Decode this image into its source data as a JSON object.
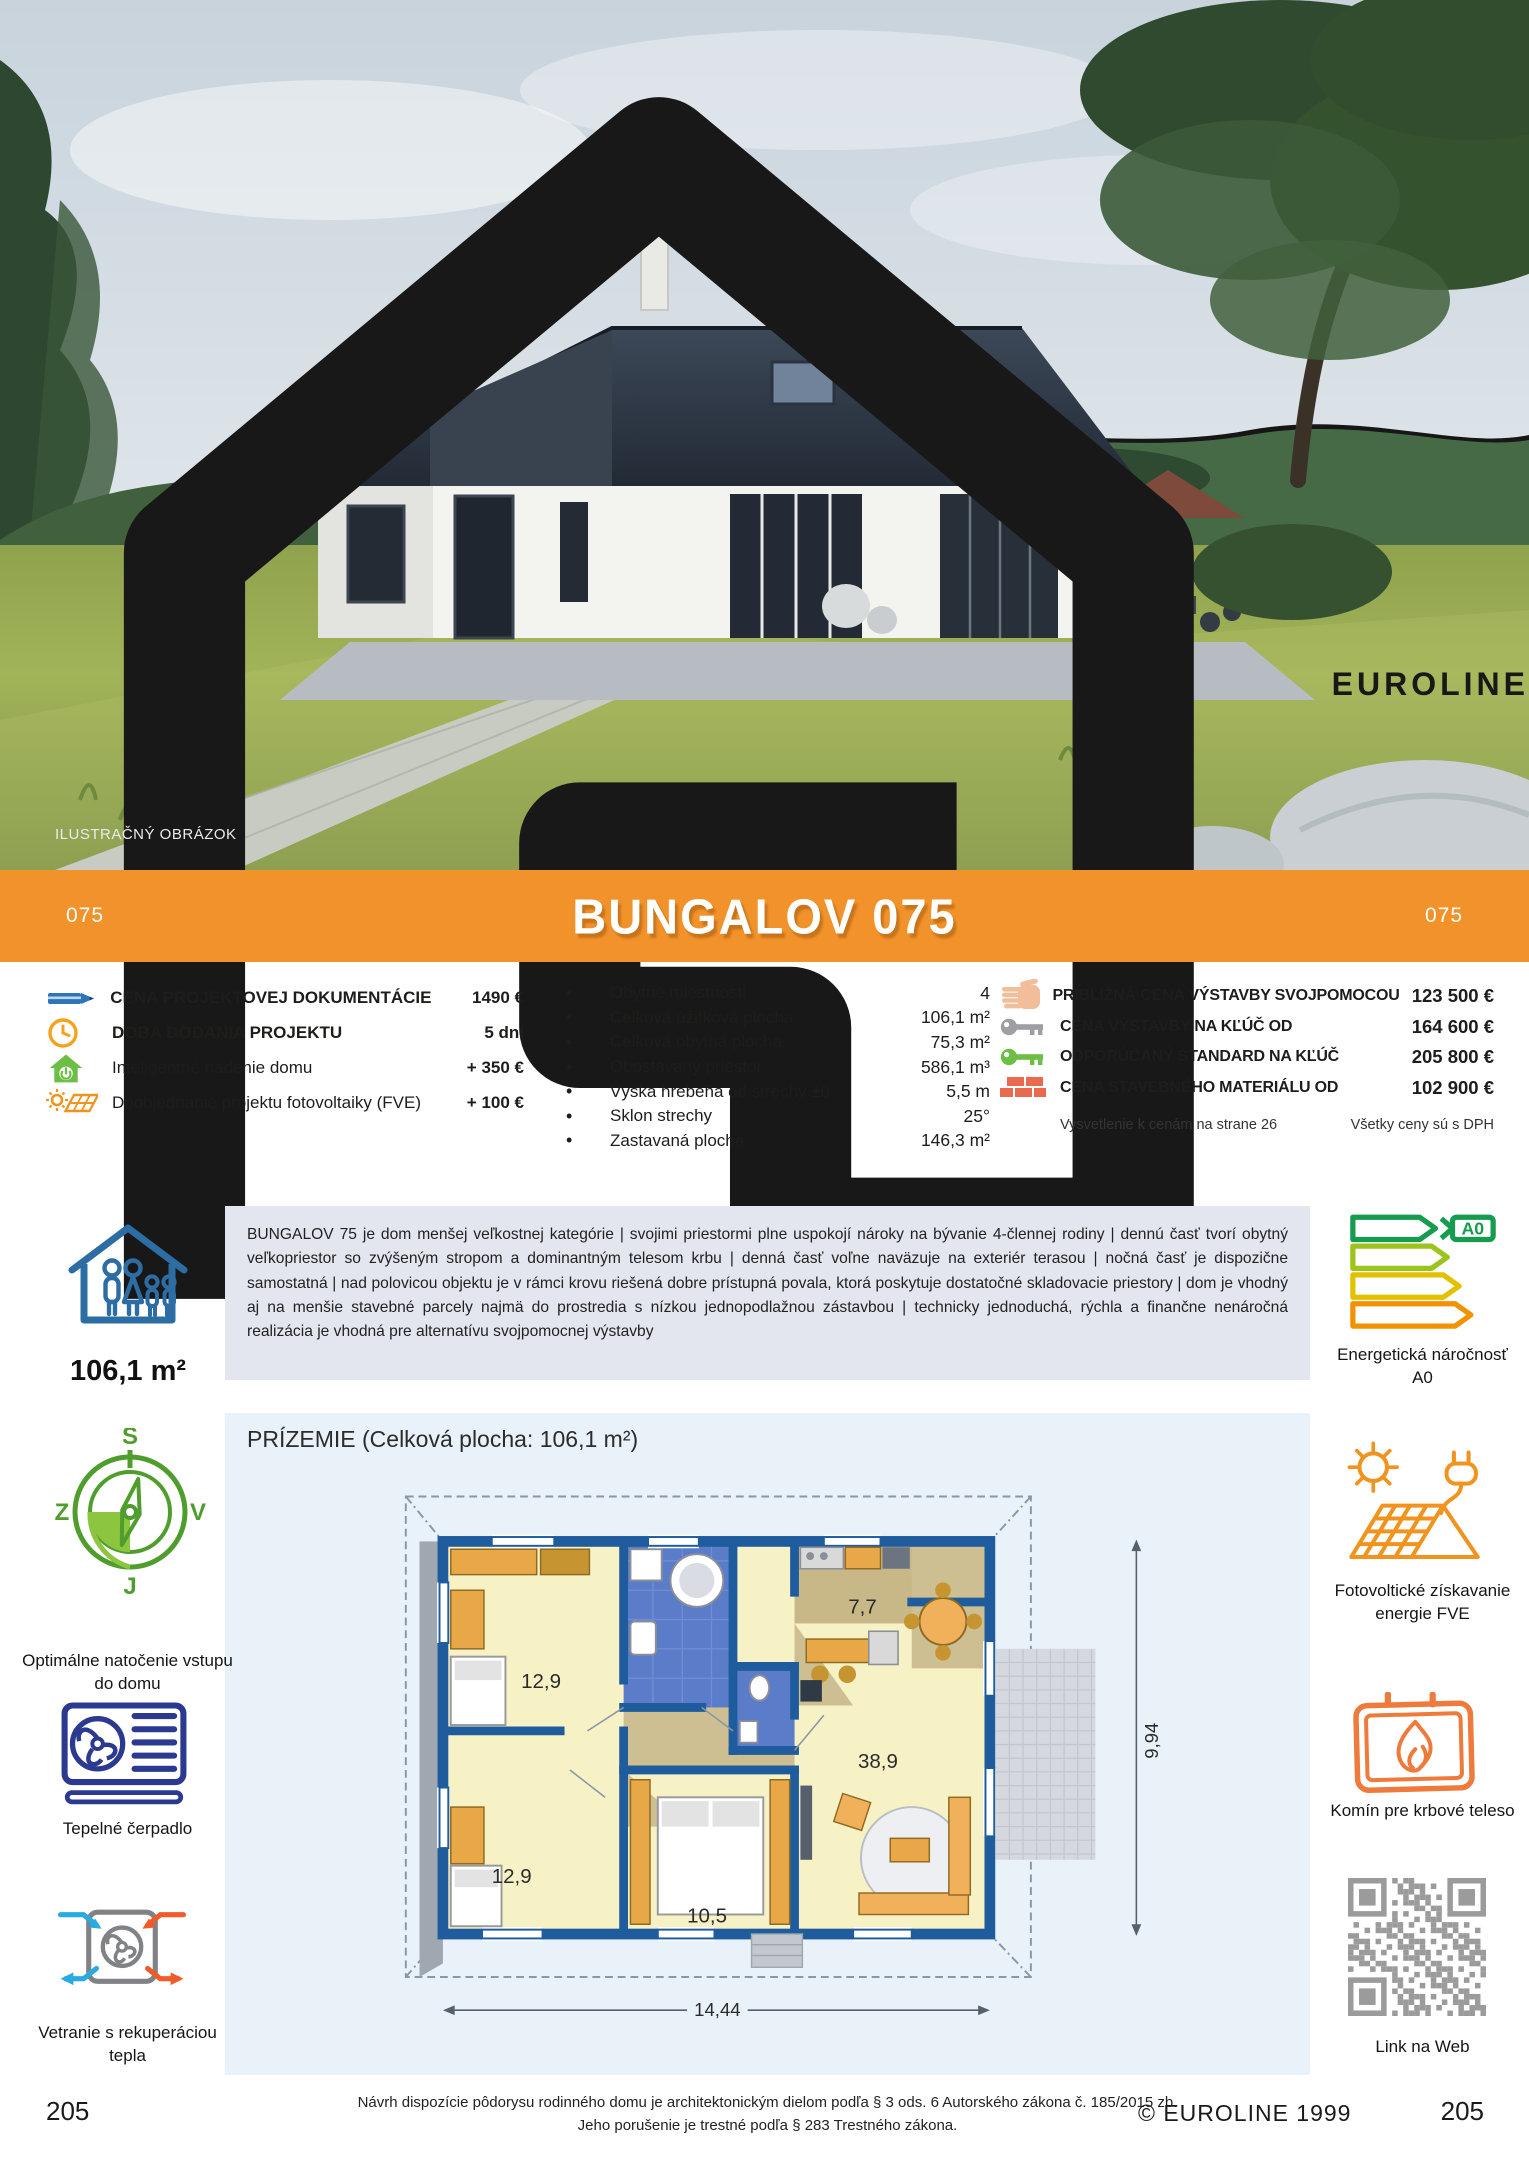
{
  "colors": {
    "banner_orange": "#F2922A",
    "plan_bg": "#E9F1F9",
    "desc_bg": "#E4E6EF",
    "wall_blue": "#1E5C9E",
    "icon_blue": "#2C6DA4",
    "icon_green": "#6CBE45",
    "icon_orange": "#F0941F"
  },
  "logo": {
    "text": "EUROLINE"
  },
  "photo": {
    "caption": "ILUSTRAČNÝ OBRÁZOK"
  },
  "banner": {
    "code_left": "075",
    "title": "BUNGALOV 075",
    "code_right": "075"
  },
  "specs": {
    "left": [
      {
        "icon": "pencil-icon",
        "label": "CENA PROJEKTOVEJ DOKUMENTÁCIE",
        "value": "1490 €"
      },
      {
        "icon": "clock-icon",
        "label": "DOBA DODANIA PROJEKTU",
        "value": "5 dní"
      },
      {
        "icon": "smart-home-icon",
        "label": "Inteligentné riadenie domu",
        "value": "+ 350 €"
      },
      {
        "icon": "solar-addon-icon",
        "label": "Doobjednanie projektu fotovoltaiky (FVE)",
        "value": "+ 100 €"
      }
    ],
    "middle": [
      {
        "label": "Obytné miestnosti",
        "value": "4"
      },
      {
        "label": "Celková úžitková plocha",
        "value": "106,1 m²"
      },
      {
        "label": "Celková obytná plocha",
        "value": "75,3 m²"
      },
      {
        "label": "Obostavaný priestor",
        "value": "586,1 m³"
      },
      {
        "label": "Výška hrebeňa od strechy ±0",
        "value": "5,5 m"
      },
      {
        "label": "Sklon strechy",
        "value": "25°"
      },
      {
        "label": "Zastavaná plocha",
        "value": "146,3 m²"
      }
    ],
    "right": [
      {
        "icon": "hand-icon",
        "label": "PRIBLIŽNÁ CENA VÝSTAVBY SVOJPOMOCOU",
        "value": "123 500 €"
      },
      {
        "icon": "key-gray-icon",
        "label": "CENA VÝSTAVBY NA KĽÚČ OD",
        "value": "164 600 €"
      },
      {
        "icon": "key-green-icon",
        "label": "ODPORÚČANÝ ŠTANDARD NA KĽÚČ",
        "value": "205 800 €"
      },
      {
        "icon": "bricks-icon",
        "label": "CENA STAVEBNÉHO MATERIÁLU OD",
        "value": "102 900 €"
      }
    ],
    "note_left": "Vysvetlenie k cenám na strane 26",
    "note_right": "Všetky ceny sú s DPH"
  },
  "area_badge": "106,1 m²",
  "description": "BUNGALOV 75 je dom menšej veľkostnej kategórie | svojimi priestormi plne uspokojí nároky na bývanie 4-člennej rodiny | dennú časť tvorí obytný veľkopriestor so zvýšeným stropom a dominantným telesom krbu | denná časť voľne naväzuje na exteriér terasou | nočná časť je dispozične samostatná | nad polovicou objektu je v rámci krovu riešená dobre prístupná povala, ktorá poskytuje dostatočné skladovacie priestory | dom je vhodný aj na menšie stavebné parcely najmä do prostredia s nízkou jednopodlažnou zástavbou | technicky jednoduchá, rýchla a finančne nenáročná realizácia je vhodná pre alternatívu svojpomocnej výstavby",
  "sidebar_left": {
    "compass": {
      "n": "S",
      "w": "Z",
      "e": "V",
      "s": "J"
    },
    "compass_caption": "Optimálne natočenie vstupu do domu",
    "heat_pump_caption": "Tepelné čerpadlo",
    "ventilation_caption": "Vetranie s rekuperáciou tepla"
  },
  "sidebar_right": {
    "energy_label": "A0",
    "energy_caption": "Energetická náročnosť A0",
    "pv_caption": "Fotovoltické získavanie energie FVE",
    "fireplace_caption": "Komín pre krbové teleso",
    "qr_caption": "Link na Web"
  },
  "plan": {
    "title": "PRÍZEMIE (Celková plocha: 106,1 m²)",
    "rooms": {
      "bedroom1": "12,9",
      "bedroom2": "12,9",
      "bedroom3": "10,5",
      "kitchen": "7,7",
      "living": "38,9"
    },
    "dim_width": "14,44",
    "dim_height": "9,94"
  },
  "footer": {
    "disclaimer_line1": "Návrh dispozície pôdorysu rodinného domu je architektonickým dielom podľa § 3 ods. 6 Autorského zákona č. 185/2015 zb.",
    "disclaimer_line2": "Jeho porušenie je trestné podľa § 283 Trestného zákona.",
    "copyright": "© EUROLINE 1999",
    "page_left": "205",
    "page_right": "205"
  }
}
